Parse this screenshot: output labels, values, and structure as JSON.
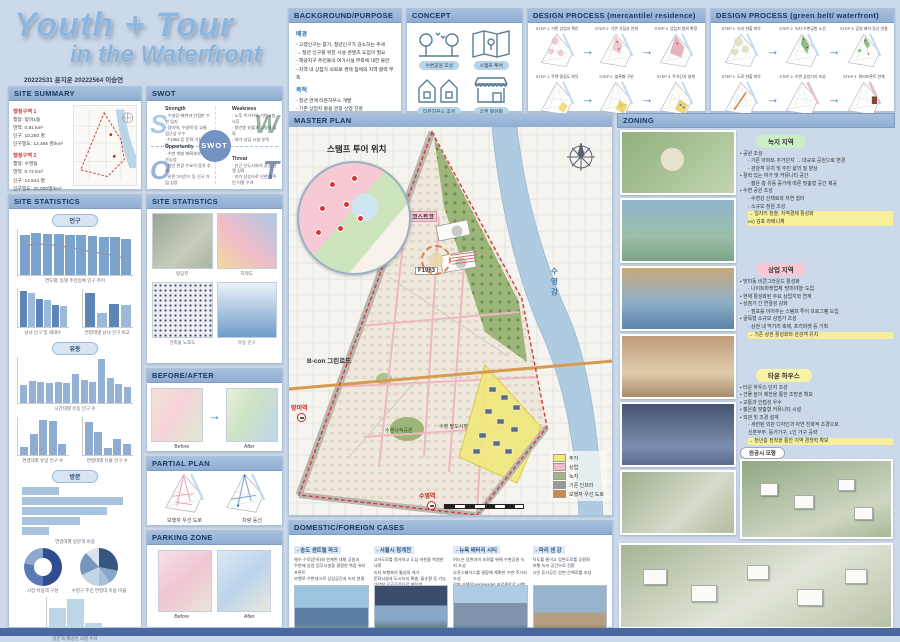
{
  "meta": {
    "title_line1": "Youth + Tour",
    "title_line2": "in the Waterfront",
    "authors": "20222531 윤지운 20222564 이승연"
  },
  "headers": {
    "site_summary": "SITE SUMMARY",
    "swot": "SWOT",
    "site_statistics": "SITE STATISTICS",
    "site_statistics2": "SITE STATISTICS",
    "before_after": "BEFORE/AFTER",
    "partial_plan": "PARTIAL PLAN",
    "parking_zone": "PARKING ZONE",
    "background": "BACKGROUND/PURPOSE",
    "concept": "CONCEPT",
    "process_mr": "DESIGN PROCESS (mercantile/ residence)",
    "process_gw": "DESIGN PROCESS (green belt/ waterfront)",
    "master_plan": "MASTER PLAN",
    "zoning": "ZONING",
    "cases": "DOMESTIC/FOREIGN CASES"
  },
  "site_summary": {
    "district1_title": "행정구역 1",
    "district1": [
      {
        "text": "행정: 망미1동"
      },
      {
        "text": "면적: 0.81 km²"
      },
      {
        "text": "인구: 10,260 명"
      },
      {
        "text": "인구밀도: 12,466 명/km²"
      }
    ],
    "district2_title": "행정구역 2",
    "district2": [
      {
        "text": "행정: 수영동"
      },
      {
        "text": "면적: 0.72 km²"
      },
      {
        "text": "인구: 14,544 명"
      },
      {
        "text": "인구밀도: 20,000명/km²"
      }
    ]
  },
  "swot": {
    "center": "SWOT",
    "s": "S",
    "w": "W",
    "o": "O",
    "t": "T",
    "strength_title": "Strength",
    "strength": [
      {
        "text": "· 수영강·해변과 인접한 수변 입지"
      },
      {
        "text": "· 망미역, 수영역 등 교통 접근성 우수"
      },
      {
        "text": "· F1963 등 문화 거점 보유"
      }
    ],
    "weakness_title": "Weakness",
    "weakness": [
      {
        "text": "· 노후 주거지와 기반시설 낙후"
      },
      {
        "text": "· 청년층 유출과 고령화 심화"
      },
      {
        "text": "· 여가·상업 시설 부족"
      }
    ],
    "opportunity_title": "Opportunity",
    "opportunity": [
      {
        "text": "· 수변 개발 계획과의 연계 가능성"
      },
      {
        "text": "· 청년 관광 수요의 증가 추세"
      },
      {
        "text": "· 비콘그라운드 등 신규 거점 성장"
      }
    ],
    "threat_title": "Threat",
    "threat": [
      {
        "text": "· 인근 신도시와의 상권 경쟁 심화"
      },
      {
        "text": "· 지가 상승으로 인한 원주민 이탈 우려"
      }
    ]
  },
  "background": {
    "s1_title": "배경",
    "s1": [
      {
        "text": "- 고령인구는 증가, 청년인구가 감소하는 추세"
      },
      {
        "text": "→ 청년 인구를 위한 시설·콘텐츠 도입이 필요"
      },
      {
        "text": "- 해당지구 주민들의 여가시설 부족에 대한 불만"
      },
      {
        "text": "- 지역 내 상점가 쇠퇴로 경제 침체와 지역 활력 부족"
      }
    ],
    "s2_title": "목적",
    "s2": [
      {
        "text": "- 청년 연계 타운하우스 개발"
      },
      {
        "text": "- 기존 상업지 활용 관광 산업 진흥"
      },
      {
        "text": "- 전통성 워터프론트 공원(수변 공원) 조성"
      },
      {
        "text": "- 지역 경제 활성화 도모"
      }
    ]
  },
  "concept": {
    "items": [
      {
        "label": "수변공원 조성"
      },
      {
        "label": "스탬프 투어"
      },
      {
        "label": "타운하우스 조성"
      },
      {
        "label": "상권 활성화"
      }
    ]
  },
  "process_mr": {
    "steps": [
      {
        "text": "STEP 1. 기존 상업지 확인"
      },
      {
        "text": "STEP 2. 기존 거점과 연계"
      },
      {
        "text": "STEP 3. 상업지 범위 확정"
      },
      {
        "text": "STEP 1. 주택 밀집도 파악"
      },
      {
        "text": "STEP 2. 블록별 구분"
      },
      {
        "text": "STEP 3. 주거단지 설계"
      }
    ]
  },
  "process_gw": {
    "steps": [
      {
        "text": "STEP 1. 녹지 현황 파악"
      },
      {
        "text": "STEP 2. 녹지·수변공원 노선"
      },
      {
        "text": "STEP 3. 공원 배치·동선 연결"
      },
      {
        "text": "STEP 1. 도로 현황 파악"
      },
      {
        "text": "STEP 2. 수변 상업거리 조성"
      },
      {
        "text": "STEP 3. 워터프론트 연계"
      }
    ]
  },
  "stats_left": {
    "pills": [
      "인구",
      "유동",
      "방문"
    ],
    "cap_a": "연도별, 동별 주민등록 인구 추이",
    "cap_b": "남녀 인구 및 세대수",
    "cap_c": "연령대별 남녀 인구 비교",
    "cap_d": "시간대별 유동 인구 수",
    "cap_e1": "연령대별 유입 인구 수",
    "cap_e2": "연령대별 유출 인구 수",
    "cap_f": "연령대별 방문객 비중",
    "cap_p1": "시장 이용객 구성",
    "cap_p2": "수영구 주민 연령대 이용 비율",
    "cap_g": "방문객 재방문 의향 수치"
  },
  "stats2": {
    "caps": [
      {
        "text": "항공뷰"
      },
      {
        "text": "지적도"
      },
      {
        "text": "건축물 노후도"
      },
      {
        "text": "유동 인구"
      }
    ]
  },
  "before_after": {
    "before": "Before",
    "after": "After"
  },
  "partial_plan": {
    "cap1": "보행자 우선 도로",
    "cap2": "차량 동선"
  },
  "parking": {
    "before": "Before",
    "after": "After"
  },
  "master_plan": {
    "inset_label": "스탬프 투어 위치",
    "labels": {
      "costco": "코스트코",
      "f1963": "F1963",
      "greenroad": "B-con 그린로드",
      "mangmi": "망미역",
      "suyeong_st": "수영역",
      "market": "수영 팔도시장",
      "park": "수영사적공원",
      "river": "수영강"
    },
    "legend": [
      {
        "text": "주거",
        "color": "#f2e97e"
      },
      {
        "text": "상업",
        "color": "#f3bcca"
      },
      {
        "text": "녹지",
        "color": "#a3b585"
      },
      {
        "text": "기존 인프라",
        "color": "#9b9b94"
      },
      {
        "text": "보행자 우선 도로",
        "color": "#c98a4b"
      }
    ]
  },
  "zoning": {
    "green": {
      "pill": "녹지 지역",
      "pill_color": "#cdeec4",
      "items": [
        {
          "text": "• 공원 조성"
        },
        {
          "text": "- 기존 아파트·주거단지 → 대규모 공원으로 변경",
          "cls": "ind"
        },
        {
          "text": "- 관광객 유치 및 주민 삶의 질 향상",
          "cls": "ind"
        },
        {
          "text": "• 활력 있는 여가 및 커뮤니티 공간"
        },
        {
          "text": "- 젊은 층 유동 증가에 따른 맞춤형 공간 제공",
          "cls": "ind"
        },
        {
          "text": "• 수변 공원 조성"
        },
        {
          "text": "- 수영강 산책로와 자연 쉼터",
          "cls": "ind"
        },
        {
          "text": "- 소규모 정원 조성",
          "cls": "ind"
        },
        {
          "text": "→ 일자리 창출, 지역경제 활성화",
          "cls": "ind hl"
        },
        {
          "text": "ex) 김포 라베니체",
          "cls": "ind hl"
        }
      ]
    },
    "pink": {
      "pill": "상업 지역",
      "pill_color": "#f8c9d4",
      "items": [
        {
          "text": "• 망미동 비콘그라운드 활성화"
        },
        {
          "text": "- 나이트마켓업체 '망미야행' 도입",
          "cls": "ind"
        },
        {
          "text": "• 현재 활성화된 주요 상업지와 연계"
        },
        {
          "text": "• 상점가 간 연결성 강화"
        },
        {
          "text": "- 점포를 이어주는 스탬프 투어 프로그램 도입",
          "cls": "ind"
        },
        {
          "text": "• 골목형 소규모 상점가 조성"
        },
        {
          "text": "- 상권 내 먹거리 축제, 프리마켓 등 기획",
          "cls": "ind"
        },
        {
          "text": "→ 기존 상권 활성화와 관광객 유치",
          "cls": "ind hl"
        }
      ]
    },
    "yellow": {
      "pill": "타운 하우스",
      "pill_color": "#f8f3a6",
      "items": [
        {
          "text": "• 타운 하우스 단지 조성"
        },
        {
          "text": "• 건물 높이 제한을 통한 조망권 확보"
        },
        {
          "text": "• 교통과 인접성 우수"
        },
        {
          "text": "• 젊은층 맞춤형 커뮤니티 시설"
        },
        {
          "text": "• 외관 및 조경 설계"
        },
        {
          "text": "- 세련된 외관 디자인과 자연 친화적 조경으로",
          "cls": "ind"
        },
        {
          "text": "신혼부부, 동거가구, 1인 가구 공략",
          "cls": "ind"
        },
        {
          "text": "→ 청년층 정착을 통한 지역 경쟁력 확보",
          "cls": "ind hl"
        }
      ]
    },
    "model_label": "완공시 모형"
  },
  "cases": {
    "items": [
      {
        "title": "- 송도 센트럴 파크",
        "lines": [
          {
            "text": "해수 수로(운하)와 연계된 대형 공원과"
          },
          {
            "text": "주변에 상업·업무시설을 결합한 복합 워터프론트"
          },
          {
            "text": "보행로·수변데크로 상업공간과 녹지 연결"
          }
        ]
      },
      {
        "title": "- 서울시 청계천",
        "lines": [
          {
            "text": "고가도로를 철거하고 도심 하천을 복원한 사례"
          },
          {
            "text": "녹지 보행축의 활성화 계기"
          },
          {
            "text": "문화시설과 도시녹지 확충, 물순환 등 기능"
          },
          {
            "text": "다양한 공공공간으로 재탄생"
          }
        ]
      },
      {
        "title": "- 뉴욕 배터리 시티",
        "lines": [
          {
            "text": "허드슨 강변과의 조화를 위해 수변공원·녹지 조성"
          },
          {
            "text": "오픈스페이스를 결합해 계획한 수변 주거지 조성"
          },
          {
            "text": "강변 산책로(esplanade) 프로젝트로 시행"
          }
        ]
      },
      {
        "title": "- 파리 센 강",
        "lines": [
          {
            "text": "차도를 줄이고 강변도로를 공원화"
          },
          {
            "text": "보행·녹지 공간으로 전환"
          },
          {
            "text": "시민 휴식공간·강변 산책로를 조성"
          }
        ]
      }
    ]
  },
  "charts": {
    "pop_trend": {
      "values": [
        88,
        92,
        90,
        89,
        88,
        86,
        84,
        83,
        83,
        78
      ],
      "color": "#7ba3cd",
      "line": [
        62,
        68,
        66,
        64,
        60,
        55,
        50,
        46,
        42,
        34
      ]
    },
    "gender": {
      "values": [
        95,
        90,
        74,
        71,
        58,
        56
      ],
      "colors": [
        "#5d86b8",
        "#9db9d8"
      ]
    },
    "age_compare": {
      "values": [
        90,
        38,
        60,
        57
      ],
      "colors": [
        "#5d86b8",
        "#9db9d8"
      ]
    },
    "float_hour": {
      "values": [
        40,
        48,
        45,
        43,
        46,
        44,
        62,
        50,
        46,
        95,
        55,
        42,
        35
      ],
      "color": "#93b2d6"
    },
    "inflow": {
      "values": [
        20,
        55,
        92,
        90,
        30
      ],
      "color": "#8fadd2"
    },
    "outflow": {
      "values": [
        88,
        60,
        18,
        42,
        28
      ],
      "color": "#8fadd2"
    },
    "purpose": {
      "values": [
        35,
        95,
        80,
        55,
        25
      ],
      "horizontal": true,
      "color": "#a9c3de"
    },
    "visit_bars": {
      "values": [
        70,
        95,
        28
      ],
      "color": "#bcd6e8"
    },
    "pie_left": {
      "values": [
        50,
        28,
        22
      ],
      "colors": [
        "#2e4d8e",
        "#5b79b4",
        "#8fa8cf"
      ]
    },
    "pie_right": {
      "values": [
        28,
        12,
        10,
        18,
        20,
        12
      ],
      "colors": [
        "#35567e",
        "#89a8c8",
        "#a9c2da",
        "#c3d6e6",
        "#7697bd",
        "#d7e3ee"
      ]
    }
  }
}
